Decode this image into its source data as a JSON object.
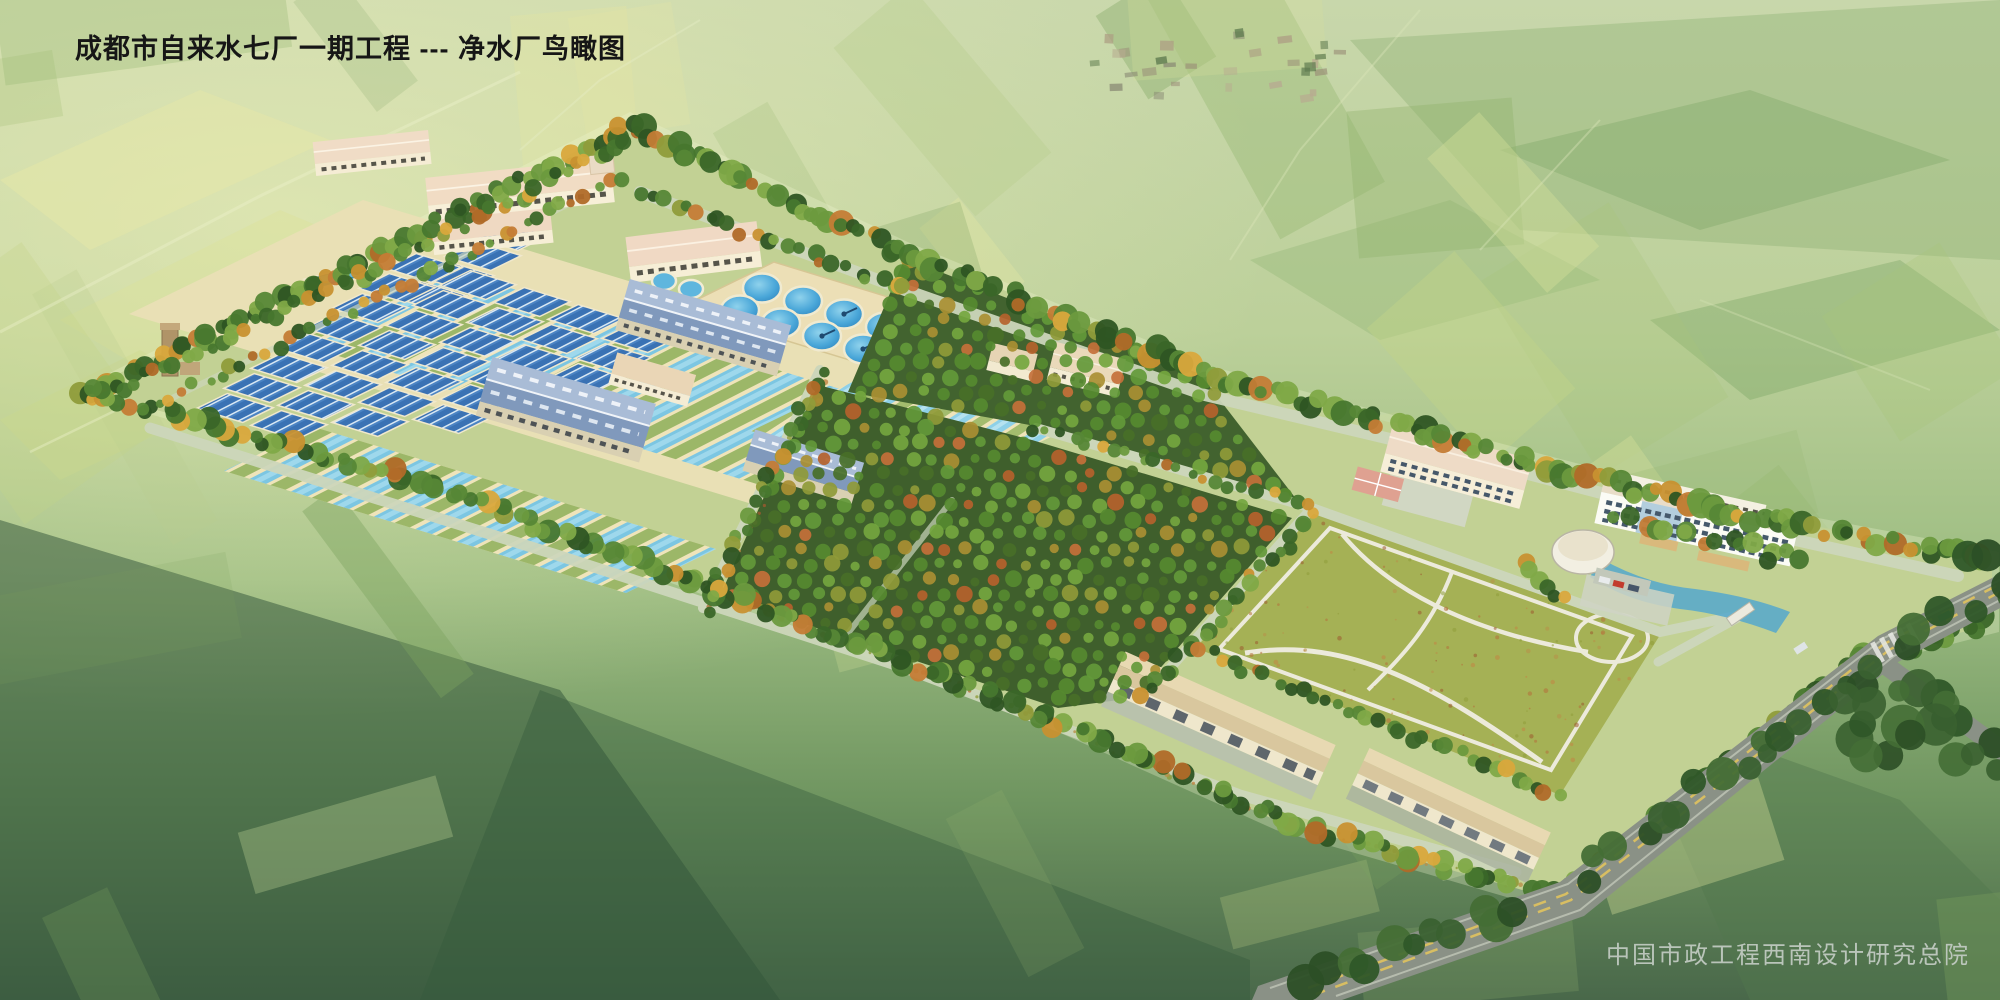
{
  "header": {
    "title": "成都市自来水七厂一期工程 --- 净水厂鸟瞰图"
  },
  "footer": {
    "credit": "中国市政工程西南设计研究总院"
  },
  "scene": {
    "description_colors": {
      "basin_water": "#7cc6e2",
      "clarifier_water": "#3f9fd2",
      "filter_tank": "#3a72b4",
      "blue_roof": "#8ba4c6",
      "beige_roof": "#eedac4",
      "foliage_green": "#47772e",
      "foliage_autumn": "#c89130",
      "lawn": "#a5b155",
      "road_outside": "#8a9186",
      "road_inside": "#ccd6ba",
      "field_light": "#dde49e"
    }
  }
}
